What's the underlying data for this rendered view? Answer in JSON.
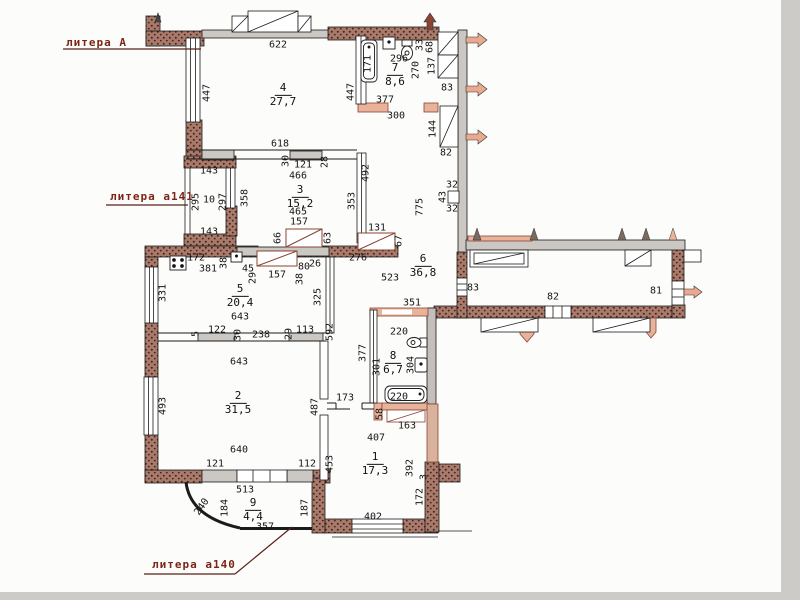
{
  "title": "Поэтажный план квартиры (литера А)",
  "colors": {
    "brick_wall": "#a87a6b",
    "brick_dot": "#46231a",
    "concrete_wall": "#cbc7c2",
    "balcony_pink": "#e9b29a",
    "label_red": "#7c2415",
    "line": "#1b1b1b"
  },
  "litera_labels": [
    {
      "text": "литера А"
    },
    {
      "text": "литера а141"
    },
    {
      "text": "литера а140"
    }
  ],
  "rooms": [
    {
      "number": "4",
      "area": "27,7",
      "x": 283,
      "y": 95
    },
    {
      "number": "7",
      "area": "8,6",
      "x": 395,
      "y": 75
    },
    {
      "number": "3",
      "area": "15,2",
      "x": 300,
      "y": 197
    },
    {
      "number": "5",
      "area": "20,4",
      "x": 240,
      "y": 296
    },
    {
      "number": "6",
      "area": "36,8",
      "x": 423,
      "y": 266
    },
    {
      "number": "8",
      "area": "6,7",
      "x": 393,
      "y": 363
    },
    {
      "number": "2",
      "area": "31,5",
      "x": 238,
      "y": 403
    },
    {
      "number": "1",
      "area": "17,3",
      "x": 375,
      "y": 464
    },
    {
      "number": "9",
      "area": "4,4",
      "x": 253,
      "y": 510
    }
  ],
  "dims": [
    {
      "t": "622",
      "x": 278,
      "y": 45
    },
    {
      "t": "447",
      "x": 207,
      "y": 93,
      "r": -90
    },
    {
      "t": "447",
      "x": 351,
      "y": 92,
      "r": -90
    },
    {
      "t": "171",
      "x": 368,
      "y": 64,
      "r": -90
    },
    {
      "t": "296",
      "x": 399,
      "y": 59
    },
    {
      "t": "270",
      "x": 416,
      "y": 70,
      "r": -90
    },
    {
      "t": "33",
      "x": 420,
      "y": 45,
      "r": -90
    },
    {
      "t": "68",
      "x": 430,
      "y": 47,
      "r": -90
    },
    {
      "t": "137",
      "x": 432,
      "y": 66,
      "r": -90
    },
    {
      "t": "83",
      "x": 447,
      "y": 88
    },
    {
      "t": "377",
      "x": 385,
      "y": 100
    },
    {
      "t": "300",
      "x": 396,
      "y": 116
    },
    {
      "t": "144",
      "x": 433,
      "y": 129,
      "r": -90
    },
    {
      "t": "82",
      "x": 446,
      "y": 153
    },
    {
      "t": "618",
      "x": 280,
      "y": 144
    },
    {
      "t": "30",
      "x": 286,
      "y": 161,
      "r": -90
    },
    {
      "t": "121",
      "x": 303,
      "y": 165
    },
    {
      "t": "28",
      "x": 325,
      "y": 162,
      "r": -90
    },
    {
      "t": "466",
      "x": 298,
      "y": 176
    },
    {
      "t": "492",
      "x": 366,
      "y": 173,
      "r": -90
    },
    {
      "t": "465",
      "x": 298,
      "y": 212
    },
    {
      "t": "157",
      "x": 299,
      "y": 222
    },
    {
      "t": "353",
      "x": 352,
      "y": 201,
      "r": -90
    },
    {
      "t": "358",
      "x": 245,
      "y": 198,
      "r": -90
    },
    {
      "t": "143",
      "x": 209,
      "y": 171
    },
    {
      "t": "295",
      "x": 196,
      "y": 202,
      "r": -90
    },
    {
      "t": "10",
      "x": 209,
      "y": 200
    },
    {
      "t": "297",
      "x": 223,
      "y": 202,
      "r": -90
    },
    {
      "t": "143",
      "x": 209,
      "y": 232
    },
    {
      "t": "66",
      "x": 278,
      "y": 238,
      "r": -90
    },
    {
      "t": "63",
      "x": 328,
      "y": 238,
      "r": -90
    },
    {
      "t": "131",
      "x": 377,
      "y": 228
    },
    {
      "t": "67",
      "x": 399,
      "y": 241,
      "r": -90
    },
    {
      "t": "276",
      "x": 358,
      "y": 258
    },
    {
      "t": "775",
      "x": 420,
      "y": 207,
      "r": -90
    },
    {
      "t": "32",
      "x": 452,
      "y": 185
    },
    {
      "t": "43",
      "x": 443,
      "y": 197,
      "r": -90
    },
    {
      "t": "32",
      "x": 452,
      "y": 209
    },
    {
      "t": "172",
      "x": 196,
      "y": 258
    },
    {
      "t": "381",
      "x": 208,
      "y": 269
    },
    {
      "t": "38",
      "x": 224,
      "y": 263,
      "r": -90
    },
    {
      "t": "45",
      "x": 248,
      "y": 269
    },
    {
      "t": "29",
      "x": 253,
      "y": 278,
      "r": -90
    },
    {
      "t": "157",
      "x": 277,
      "y": 275
    },
    {
      "t": "80",
      "x": 304,
      "y": 267
    },
    {
      "t": "26",
      "x": 315,
      "y": 264
    },
    {
      "t": "38",
      "x": 300,
      "y": 279,
      "r": -90
    },
    {
      "t": "523",
      "x": 390,
      "y": 278
    },
    {
      "t": "331",
      "x": 163,
      "y": 293,
      "r": -90
    },
    {
      "t": "643",
      "x": 240,
      "y": 317
    },
    {
      "t": "325",
      "x": 318,
      "y": 297,
      "r": -90
    },
    {
      "t": "122",
      "x": 217,
      "y": 330
    },
    {
      "t": "5",
      "x": 196,
      "y": 334,
      "r": -90
    },
    {
      "t": "30",
      "x": 238,
      "y": 335,
      "r": -90
    },
    {
      "t": "238",
      "x": 261,
      "y": 335
    },
    {
      "t": "29",
      "x": 289,
      "y": 334,
      "r": -90
    },
    {
      "t": "113",
      "x": 305,
      "y": 330
    },
    {
      "t": "592",
      "x": 330,
      "y": 332,
      "r": -90
    },
    {
      "t": "351",
      "x": 412,
      "y": 303
    },
    {
      "t": "220",
      "x": 399,
      "y": 332
    },
    {
      "t": "377",
      "x": 363,
      "y": 353,
      "r": -90
    },
    {
      "t": "301",
      "x": 377,
      "y": 367,
      "r": -90
    },
    {
      "t": "304",
      "x": 411,
      "y": 365,
      "r": -90
    },
    {
      "t": "220",
      "x": 399,
      "y": 397
    },
    {
      "t": "58",
      "x": 380,
      "y": 414,
      "r": -90
    },
    {
      "t": "163",
      "x": 407,
      "y": 426
    },
    {
      "t": "173",
      "x": 345,
      "y": 398
    },
    {
      "t": "643",
      "x": 239,
      "y": 362
    },
    {
      "t": "493",
      "x": 163,
      "y": 406,
      "r": -90
    },
    {
      "t": "487",
      "x": 315,
      "y": 407,
      "r": -90
    },
    {
      "t": "640",
      "x": 239,
      "y": 450
    },
    {
      "t": "121",
      "x": 215,
      "y": 464
    },
    {
      "t": "112",
      "x": 307,
      "y": 464
    },
    {
      "t": "453",
      "x": 330,
      "y": 464,
      "r": -90
    },
    {
      "t": "513",
      "x": 245,
      "y": 490
    },
    {
      "t": "240",
      "x": 202,
      "y": 507,
      "r": -55
    },
    {
      "t": "184",
      "x": 225,
      "y": 508,
      "r": -90
    },
    {
      "t": "357",
      "x": 265,
      "y": 527
    },
    {
      "t": "187",
      "x": 305,
      "y": 508,
      "r": -90
    },
    {
      "t": "407",
      "x": 376,
      "y": 438
    },
    {
      "t": "392",
      "x": 410,
      "y": 468,
      "r": -90
    },
    {
      "t": "3",
      "x": 424,
      "y": 477,
      "r": -90
    },
    {
      "t": "172",
      "x": 420,
      "y": 497,
      "r": -90
    },
    {
      "t": "402",
      "x": 373,
      "y": 517
    },
    {
      "t": "83",
      "x": 473,
      "y": 288
    },
    {
      "t": "82",
      "x": 553,
      "y": 297
    },
    {
      "t": "81",
      "x": 656,
      "y": 291
    }
  ]
}
